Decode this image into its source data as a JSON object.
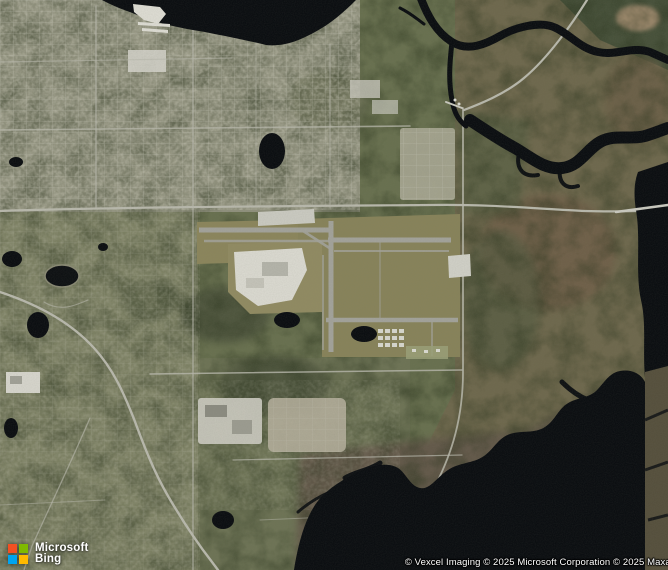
{
  "logo": {
    "brand_top": "Microsoft",
    "brand_bottom": "Bing",
    "colors": {
      "red": "#F25022",
      "green": "#7FBA00",
      "blue": "#00A4EF",
      "yellow": "#FFB900"
    }
  },
  "attribution": {
    "text": "© Vexcel Imaging © 2025 Microsoft Corporation © 2025 Maxar"
  }
}
